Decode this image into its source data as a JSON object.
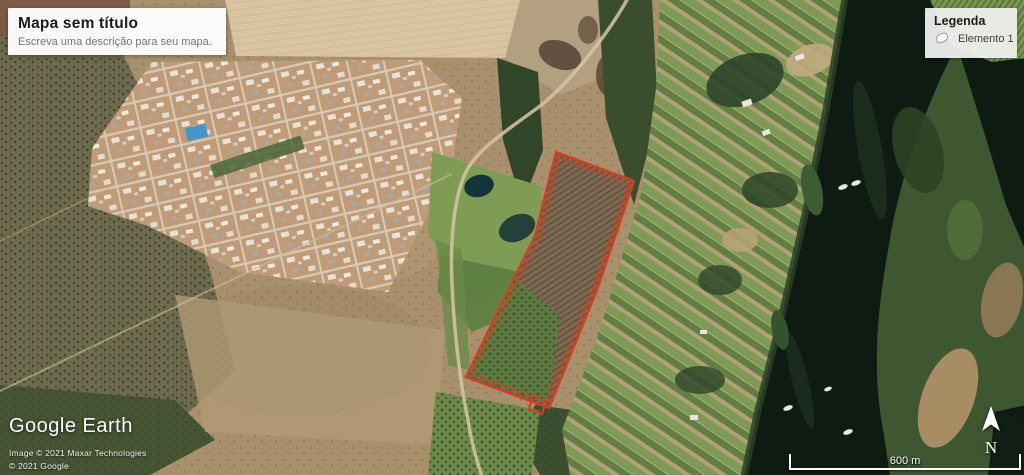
{
  "title_panel": {
    "title": "Mapa sem título",
    "subtitle": "Escreva uma descrição para seu mapa."
  },
  "legend_panel": {
    "title": "Legenda",
    "items": [
      {
        "label": "Elemento 1",
        "icon": "polygon-swatch-icon"
      }
    ]
  },
  "branding": {
    "logo_text": "Google Earth",
    "attribution_line1": "Image © 2021 Maxar Technologies",
    "attribution_line2": "© 2021 Google"
  },
  "compass": {
    "north_label": "N"
  },
  "scale_bar": {
    "label": "600 m"
  },
  "annotations": {
    "polygon_element": {
      "label": "Elemento 1",
      "stroke_color": "#da3b20"
    }
  }
}
